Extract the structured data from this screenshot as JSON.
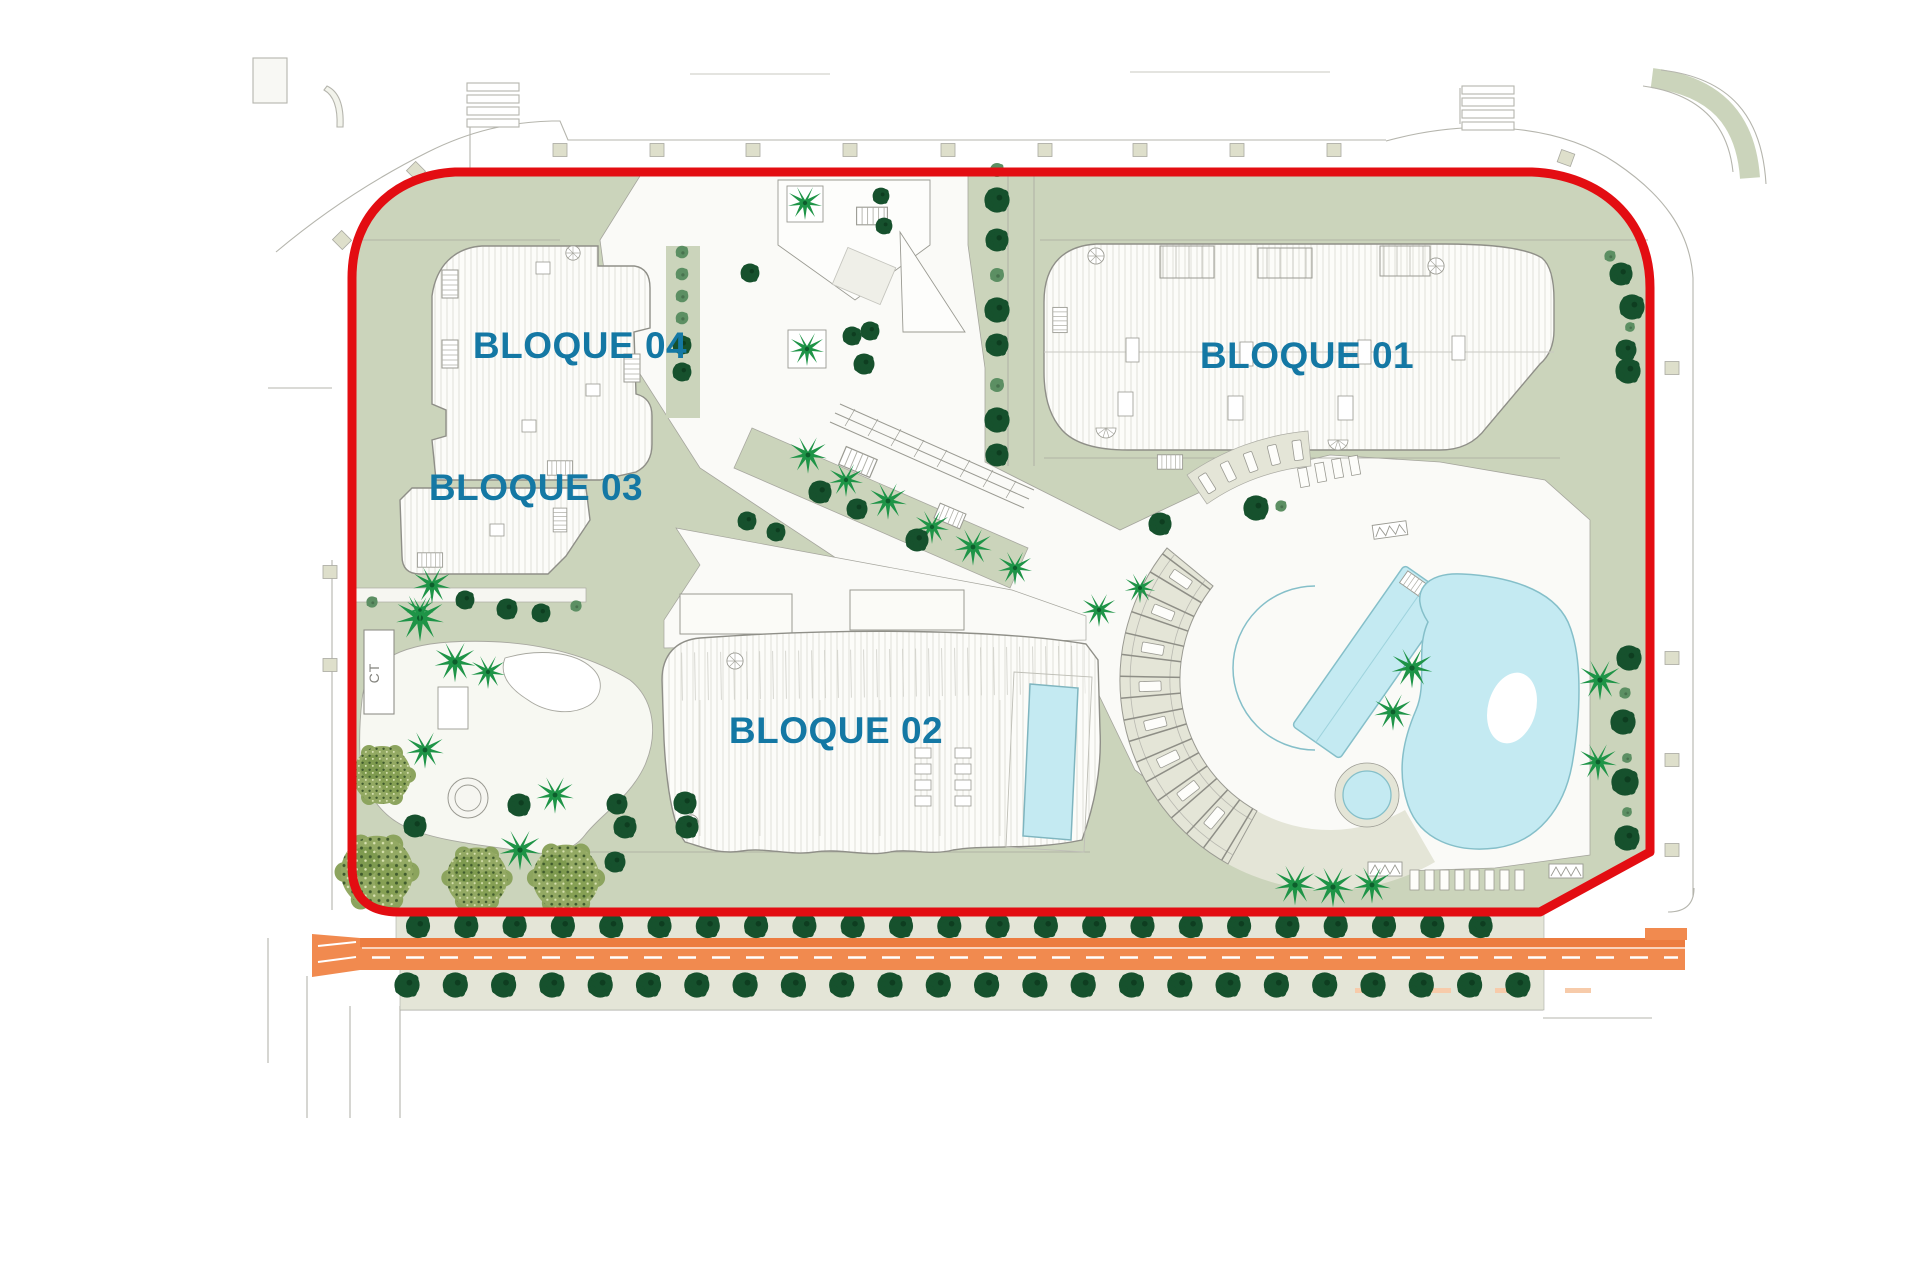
{
  "labels": {
    "block01": "BLOQUE 01",
    "block02": "BLOQUE 02",
    "block03": "BLOQUE 03",
    "block04": "BLOQUE 04",
    "ct": "CT"
  },
  "colors": {
    "boundary_red": "#E30D12",
    "label_teal": "#1478A4",
    "site_green": "#CBD4BB",
    "deck_beige": "#E4E5D7",
    "pool_cyan": "#C4EAF2",
    "road_orange": "#F18A4F",
    "road_orange_dark": "#EC7C40",
    "tree_dark_green": "#16512D",
    "tree_light_green": "#5C8F63",
    "palm_green": "#1E9447",
    "bush_olive": "#93A963"
  }
}
